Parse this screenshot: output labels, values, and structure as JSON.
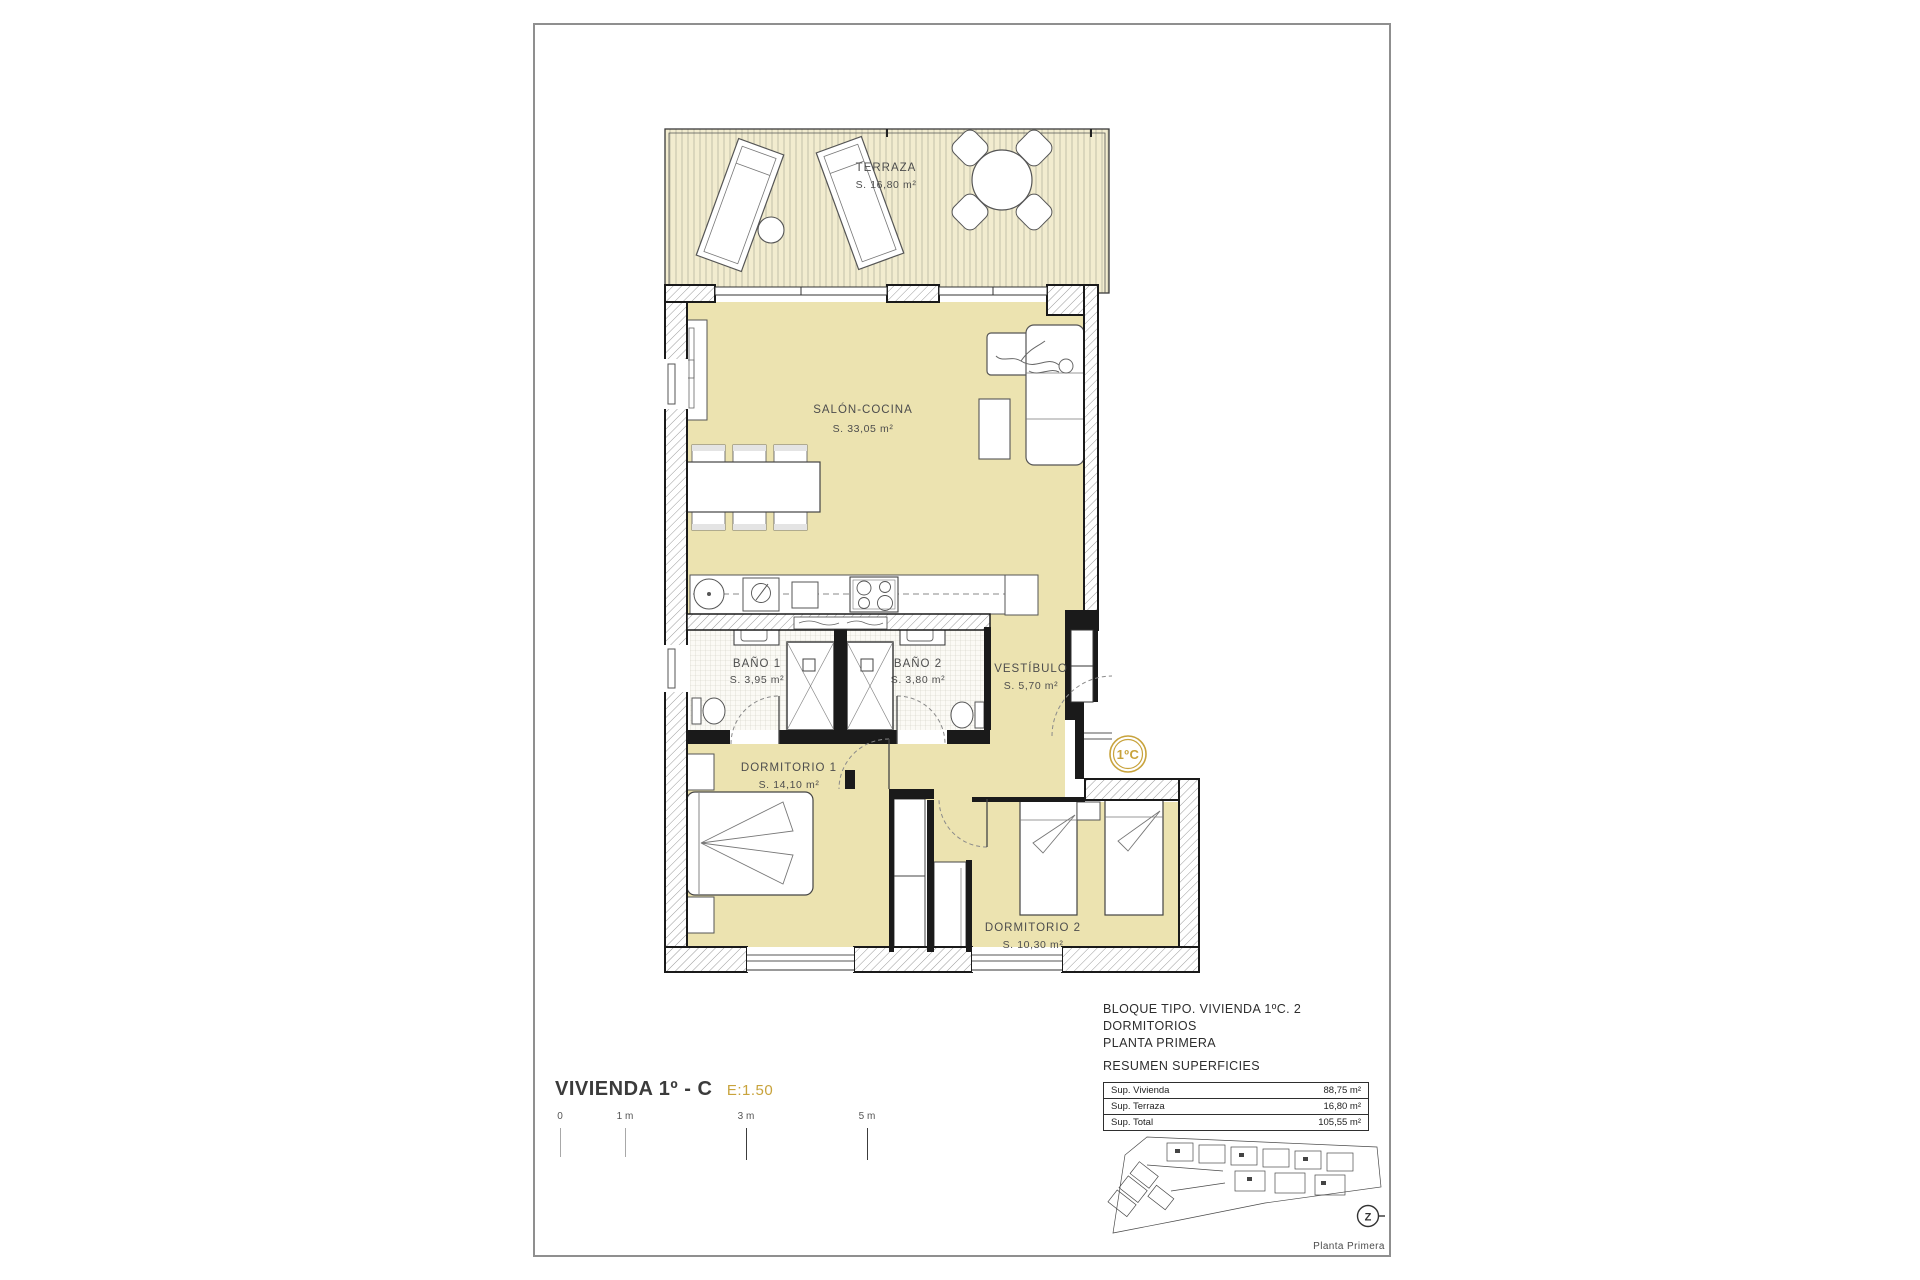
{
  "plan": {
    "unit_badge": "1ºC",
    "rooms": {
      "terraza": {
        "name": "TERRAZA",
        "area": "S. 16,80 m²"
      },
      "salon_cocina": {
        "name": "SALÓN-COCINA",
        "area": "S. 33,05 m²"
      },
      "bano1": {
        "name": "BAÑO 1",
        "area": "S. 3,95 m²"
      },
      "bano2": {
        "name": "BAÑO 2",
        "area": "S. 3,80 m²"
      },
      "vestibulo": {
        "name": "VESTÍBULO",
        "area": "S. 5,70 m²"
      },
      "dormitorio1": {
        "name": "DORMITORIO 1",
        "area": "S. 14,10 m²"
      },
      "dormitorio2": {
        "name": "DORMITORIO 2",
        "area": "S. 10,30 m²"
      }
    }
  },
  "title_block": {
    "title": "VIVIENDA 1º - C",
    "scale": "E:1.50"
  },
  "scale_bar": {
    "labels": [
      "0",
      "1 m",
      "3 m",
      "5 m"
    ]
  },
  "summary": {
    "heading_line1": "BLOQUE TIPO. VIVIENDA 1ºC. 2 DORMITORIOS",
    "heading_line2": "PLANTA PRIMERA",
    "heading_line3": "RESUMEN SUPERFICIES",
    "rows": [
      {
        "label": "Sup. Vivienda",
        "value": "88,75 m²"
      },
      {
        "label": "Sup. Terraza",
        "value": "16,80 m²"
      },
      {
        "label": "Sup. Total",
        "value": "105,55 m²"
      }
    ]
  },
  "key_plan": {
    "caption": "Planta Primera",
    "north_label": "Z"
  },
  "colors": {
    "accent_gold": "#C8A33C",
    "floor_tan": "#ECE3B0",
    "wall_black": "#1a1a1a"
  }
}
